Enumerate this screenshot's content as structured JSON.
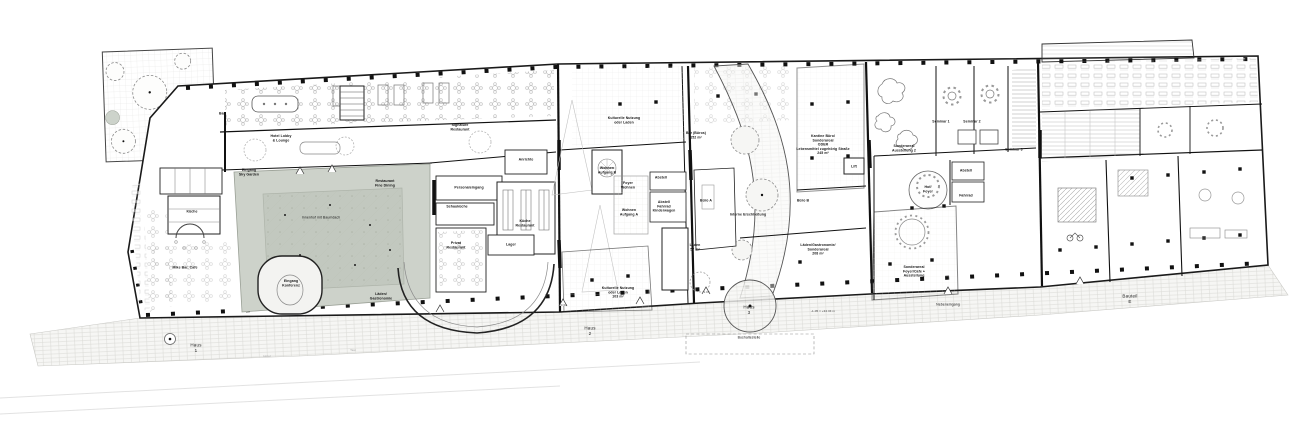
{
  "colors": {
    "wall": "#1a1a1a",
    "courtyard_green": "#cdd2ca",
    "canopy_green": "#c2c8bf",
    "paving_gray": "#f6f6f4",
    "line_gray": "#9a9a9a"
  },
  "icons": {
    "tree-icon": "scalloped dashed circle with center dot",
    "column-icon": "small black square",
    "stair-icon": "rect with step lines",
    "table-icon": "circle table with chair dots",
    "arch-icon": "double quarter-circle arcade"
  },
  "labels": {
    "bar": "Bar",
    "hotel_lobby": "Hotel Lobby\n& Lounge",
    "signature_restaurant": "Signature\nRestaurant",
    "kueche_hotel": "Küche",
    "mike_bar_cafe": "Mike Bar, Cafe",
    "eingang_sky_garden": "Eingang\nSky Garden",
    "restaurant_fine_dining": "Restaurant\nFine Dining",
    "innenhof": "Innenhof mit Baumdach",
    "eingang_konferenz": "Eingang\nKonferenz",
    "laeden_gastronomie": "Läden/\nGastronomie",
    "personaleingang": "Personaleingang",
    "schaukueche": "Schauküche",
    "kueche_restaurant": "Küche\nRestaurant",
    "lager": "Lager",
    "privat_restaurant": "Privat\nRestaurant",
    "anrichte": "Anrichte",
    "kulturelle_nutzung_laden": "Kulturelle Nutzung\noder Laden",
    "bar_bueros": "Bar (Büros)\n152 m²",
    "wohnen_aufgang_b": "Wohnen\nAufgang B",
    "foyer_wohnen": "Foyer\nWohnen",
    "wohnen_aufgang_a": "Wohnen\nAufgang A",
    "abstell": "Abstell",
    "abstell_fahrrad": "Abstell\nFahrrad\nKinderwagen",
    "laden_57": "Laden\n57 m²",
    "kulturelle_nutzung_103": "Kulturelle Nutzung\noder Laden\n103 m²",
    "buero_a": "Büro A",
    "buero_b": "Büro B",
    "interne_erschliessung": "Interne Erschließung",
    "laeden_sonderareal_208": "Läden/Gastronomie/\nSonderareal\n208 m²",
    "kantine": "Kantine Büro/\nSonderareal\nODER\nLebensmittel zugehörig Straße\n245 m²",
    "lift": "Lift",
    "sonderareal_ausstellung": "Sonderareal\nAusstellung 2",
    "seminar_1": "Seminar 1",
    "seminar_2": "Seminar 2",
    "seminar_3": "Seminar 3",
    "hof_foyer": "Hof/\nFoyer",
    "abstell2": "Abstell",
    "fahrrad": "Fahrrad",
    "sonderareal_foyer_cafe": "Sonderareal\nFoyer/Cafe +\nAusstellung",
    "nebeneingang": "Nebeneingang",
    "haus_1": "Haus\n1",
    "haus_2": "Haus\n2",
    "haus_3": "Haus\n3",
    "bushaltestelle": "Bushaltestelle",
    "bauteil_e": "Bauteil\nE",
    "hotel_street": "Hotel",
    "taxi_street": "Taxi",
    "elev_1": "±0.00",
    "elev_2": "-1.05",
    "elev_3": "-1.05 = +34.34 m"
  }
}
